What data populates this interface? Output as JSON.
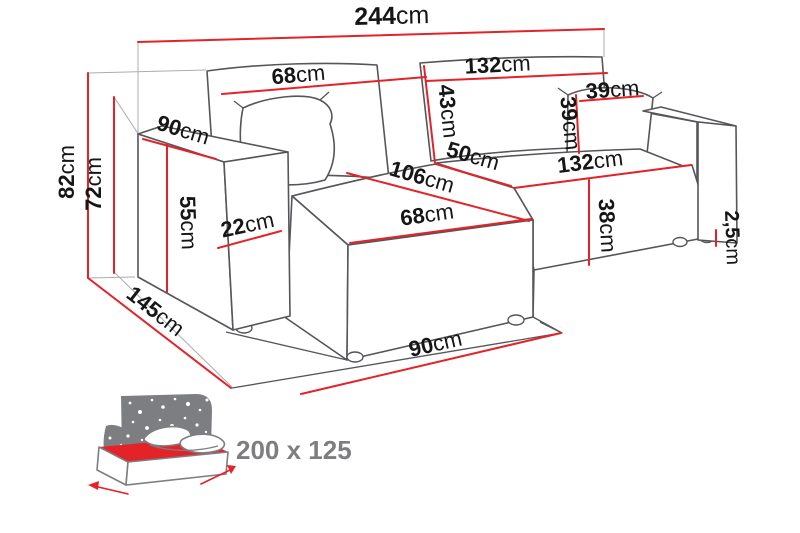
{
  "title": "Corner sofa dimensions diagram",
  "colors": {
    "dimension_red": "#e42329",
    "outline_gray": "#55565a",
    "construction_gray": "#aaacaf",
    "label_black": "#161616",
    "icon_gray": "#7d7e82"
  },
  "dimensions": {
    "total_width": {
      "num": "244",
      "unit": "cm"
    },
    "back_left_width": {
      "num": "68",
      "unit": "cm"
    },
    "back_right_width": {
      "num": "132",
      "unit": "cm"
    },
    "backrest_height": {
      "num": "43",
      "unit": "cm"
    },
    "cushion_width": {
      "num": "39",
      "unit": "cm"
    },
    "cushion_height": {
      "num": "39",
      "unit": "cm"
    },
    "armrest_depth": {
      "num": "90",
      "unit": "cm"
    },
    "total_height": {
      "num": "82",
      "unit": "cm"
    },
    "back_height": {
      "num": "72",
      "unit": "cm"
    },
    "armrest_height": {
      "num": "55",
      "unit": "cm"
    },
    "armrest_width": {
      "num": "22",
      "unit": "cm"
    },
    "corner_seat_depth": {
      "num": "50",
      "unit": "cm"
    },
    "chaise_length": {
      "num": "106",
      "unit": "cm"
    },
    "chaise_width": {
      "num": "68",
      "unit": "cm"
    },
    "seat_front_width": {
      "num": "132",
      "unit": "cm"
    },
    "seat_height": {
      "num": "38",
      "unit": "cm"
    },
    "leg_height": {
      "num": "2,5",
      "unit": "cm"
    },
    "total_depth": {
      "num": "145",
      "unit": "cm"
    },
    "right_depth": {
      "num": "90",
      "unit": "cm"
    }
  },
  "sleeping_area": {
    "label": "200 x 125",
    "icon": "sofa-bed-storage-icon"
  }
}
